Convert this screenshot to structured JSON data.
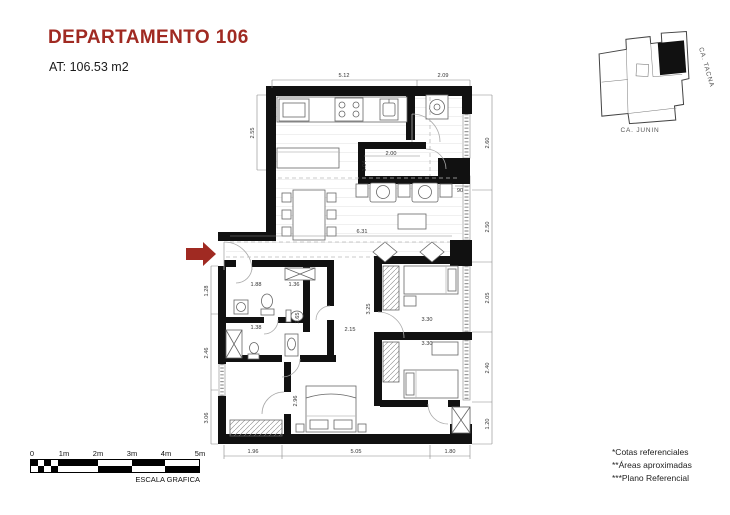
{
  "title": "DEPARTAMENTO 106",
  "area_label": "AT: 106.53 m2",
  "colors": {
    "accent": "#A02A22",
    "wall": "#111111"
  },
  "map": {
    "street_side": "CA. TACNA",
    "street_bottom": "CA. JUNIN"
  },
  "scale_bar": {
    "tick_labels": [
      "0",
      "1m",
      "2m",
      "3m",
      "4m",
      "5m"
    ],
    "caption": "ESCALA GRAFICA"
  },
  "notes": {
    "line1": "*Cotas referenciales",
    "line2": "**Áreas aproximadas",
    "line3": "***Plano Referencial"
  },
  "plan": {
    "dims": {
      "t1": "5.12",
      "t2": "2.09",
      "b1": "1.96",
      "b2": "5.05",
      "b3": "1.80",
      "l1": "2.55",
      "l2": "1.28",
      "l3": "2.46",
      "l4": "3.06",
      "r1": "2.60",
      "r2": "2.50",
      "r3": "2.05",
      "r4": "2.40",
      "r5": "1.20",
      "storage_w": "2.00",
      "storage_h": "1.04",
      "hall": "6.31",
      "door": "90",
      "bath1": "1.88",
      "bath2": "1.36",
      "bath3": "1.38",
      "bath4": "2.65",
      "bath5": "3.25",
      "bath6": "2.15",
      "bed2": "3.30",
      "bed3": "3.30",
      "master": "2.96"
    }
  }
}
